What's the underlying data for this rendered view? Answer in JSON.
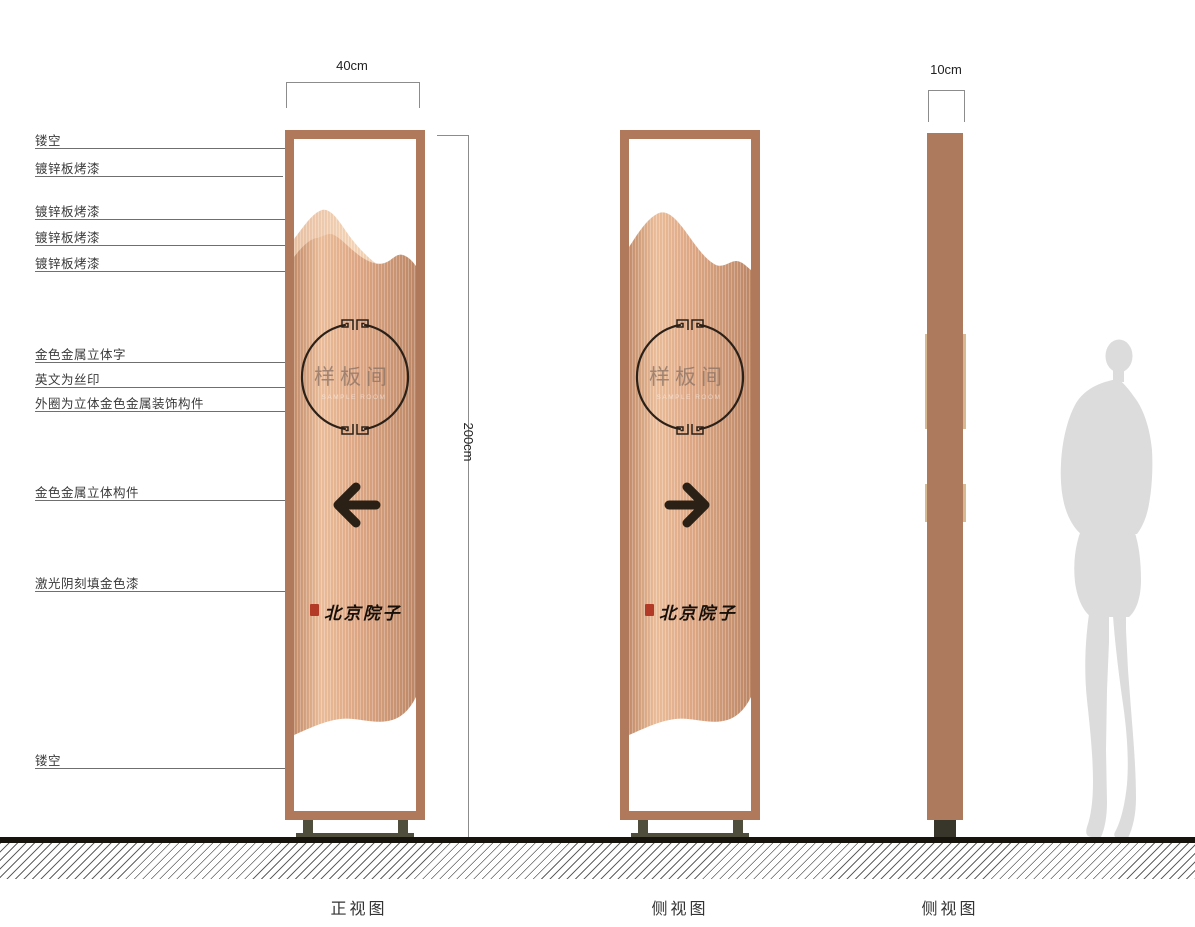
{
  "drawing": {
    "dimensions": {
      "front_width": "40cm",
      "height": "200cm",
      "side_depth": "10cm"
    },
    "annotations": [
      {
        "label": "镂空"
      },
      {
        "label": "镀锌板烤漆"
      },
      {
        "label": "镀锌板烤漆"
      },
      {
        "label": "镀锌板烤漆"
      },
      {
        "label": "镀锌板烤漆"
      },
      {
        "label": "金色金属立体字"
      },
      {
        "label": "英文为丝印"
      },
      {
        "label": "外圈为立体金色金属装饰构件"
      },
      {
        "label": "金色金属立体构件"
      },
      {
        "label": "激光阴刻填金色漆"
      },
      {
        "label": "镂空"
      }
    ],
    "captions": {
      "front_view": "正视图",
      "side_view_1": "侧视图",
      "side_view_2": "侧视图"
    },
    "sign": {
      "circle_text": "样板间",
      "english_subtitle": "SAMPLE ROOM",
      "brand_text": "北京院子"
    },
    "colors": {
      "frame_copper": "#b1795c",
      "panel_copper": "#e2ab88",
      "panel_light": "#f2ccae",
      "base_olive": "#4f4d3b",
      "ink_dark": "#2b2118",
      "seal_red": "#b43a28",
      "silhouette_gray": "#dcdcdc"
    }
  }
}
